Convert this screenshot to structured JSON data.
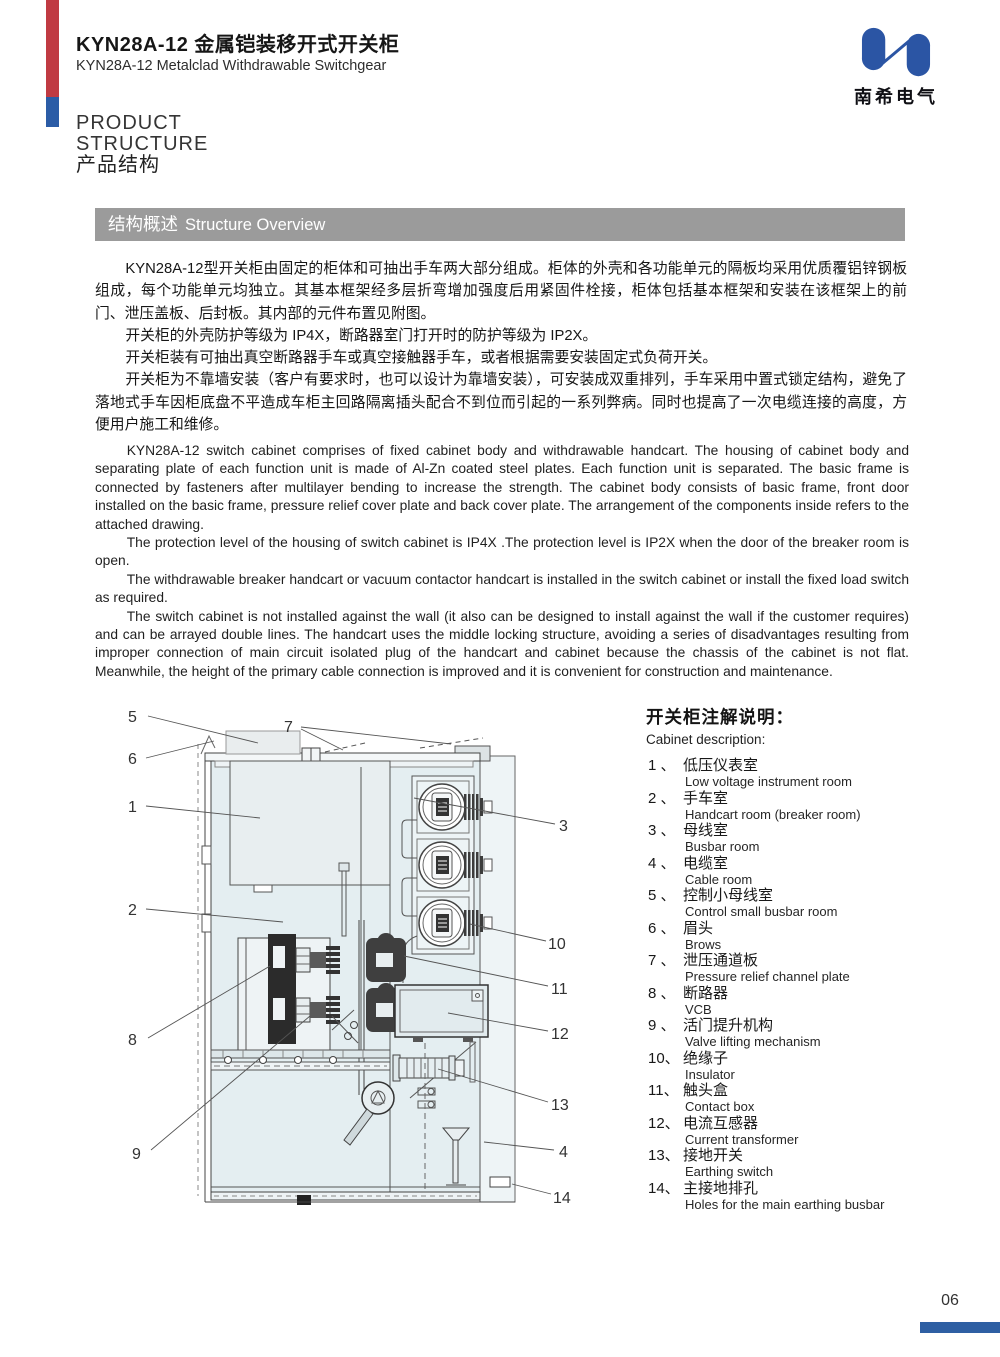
{
  "header": {
    "title_zh": "KYN28A-12 金属铠装移开式开关柜",
    "title_en": "KYN28A-12 Metalclad Withdrawable Switchgear",
    "logo_text": "南希电气"
  },
  "section": {
    "line1": "PRODUCT",
    "line2": "STRUCTURE",
    "line3": "产品结构"
  },
  "banner": {
    "zh": "结构概述",
    "en": "Structure Overview"
  },
  "intro": {
    "zh": {
      "p1": "KYN28A-12型开关柜由固定的柜体和可抽出手车两大部分组成。柜体的外壳和各功能单元的隔板均采用优质覆铝锌钢板组成，每个功能单元均独立。其基本框架经多层折弯增加强度后用紧固件栓接，柜体包括基本框架和安装在该框架上的前门、泄压盖板、后封板。其内部的元件布置见附图。",
      "p2": "开关柜的外壳防护等级为 IP4X，断路器室门打开时的防护等级为 IP2X。",
      "p3": "开关柜装有可抽出真空断路器手车或真空接触器手车，或者根据需要安装固定式负荷开关。",
      "p4": "开关柜为不靠墙安装（客户有要求时，也可以设计为靠墙安装），可安装成双重排列，手车采用中置式锁定结构，避免了落地式手车因柜底盘不平造成车柜主回路隔离插头配合不到位而引起的一系列弊病。同时也提高了一次电缆连接的高度，方便用户施工和维修。"
    },
    "en": {
      "p1": "KYN28A-12 switch cabinet comprises of fixed cabinet body and withdrawable handcart. The housing of cabinet body and separating plate of each function unit is made of Al-Zn coated steel plates. Each function unit is separated. The basic frame is connected by fasteners after multilayer bending to increase the strength. The cabinet body consists of basic frame, front door installed on the basic frame, pressure relief cover plate and back cover plate. The arrangement of the components inside refers to the attached drawing.",
      "p2": "The protection level of the housing of switch cabinet is IP4X .The protection level is IP2X when the door of the breaker room is open.",
      "p3": "The withdrawable breaker handcart or vacuum contactor handcart is installed in the switch cabinet or install the fixed load switch as required.",
      "p4": "The switch cabinet is not installed against the wall (it also can be designed to install against the wall if the customer requires) and can be arrayed double lines. The handcart uses the middle locking structure, avoiding a series of disadvantages resulting from improper connection of main circuit isolated plug of the handcart and cabinet because the chassis of the cabinet is not flat. Meanwhile, the height of the primary cable connection is improved and it is convenient for construction and maintenance."
    }
  },
  "diagram": {
    "callouts": {
      "c1": "1",
      "c2": "2",
      "c3": "3",
      "c4": "4",
      "c5": "5",
      "c6": "6",
      "c7": "7",
      "c8": "8",
      "c9": "9",
      "c10": "10",
      "c11": "11",
      "c12": "12",
      "c13": "13",
      "c14": "14"
    }
  },
  "legend": {
    "title_zh": "开关柜注解说明：",
    "title_en": "Cabinet description:",
    "items": [
      {
        "num": "1 、",
        "zh": "低压仪表室",
        "en": "Low voltage instrument room"
      },
      {
        "num": "2 、",
        "zh": "手车室",
        "en": "Handcart room (breaker room)"
      },
      {
        "num": "3 、",
        "zh": "母线室",
        "en": "Busbar room"
      },
      {
        "num": "4 、",
        "zh": "电缆室",
        "en": "Cable room"
      },
      {
        "num": "5 、",
        "zh": "控制小母线室",
        "en": "Control small busbar room"
      },
      {
        "num": "6 、",
        "zh": "眉头",
        "en": "Brows"
      },
      {
        "num": "7 、",
        "zh": "泄压通道板",
        "en": "Pressure relief channel plate"
      },
      {
        "num": "8 、",
        "zh": "断路器",
        "en": "VCB"
      },
      {
        "num": "9 、",
        "zh": "活门提升机构",
        "en": "Valve lifting mechanism"
      },
      {
        "num": "10、",
        "zh": "绝缘子",
        "en": "Insulator"
      },
      {
        "num": "11、",
        "zh": "触头盒",
        "en": "Contact box"
      },
      {
        "num": "12、",
        "zh": "电流互感器",
        "en": "Current transformer"
      },
      {
        "num": "13、",
        "zh": "接地开关",
        "en": "Earthing switch"
      },
      {
        "num": "14、",
        "zh": "主接地排孔",
        "en": "Holes for the main earthing busbar"
      }
    ]
  },
  "footer": {
    "page": "06"
  },
  "colors": {
    "accent_red": "#c03a42",
    "accent_blue": "#2b5ca6",
    "banner_gray": "#9b9b9b",
    "logo_blue": "#2b55a4",
    "footer_bar_blue": "#2e5fa3"
  }
}
